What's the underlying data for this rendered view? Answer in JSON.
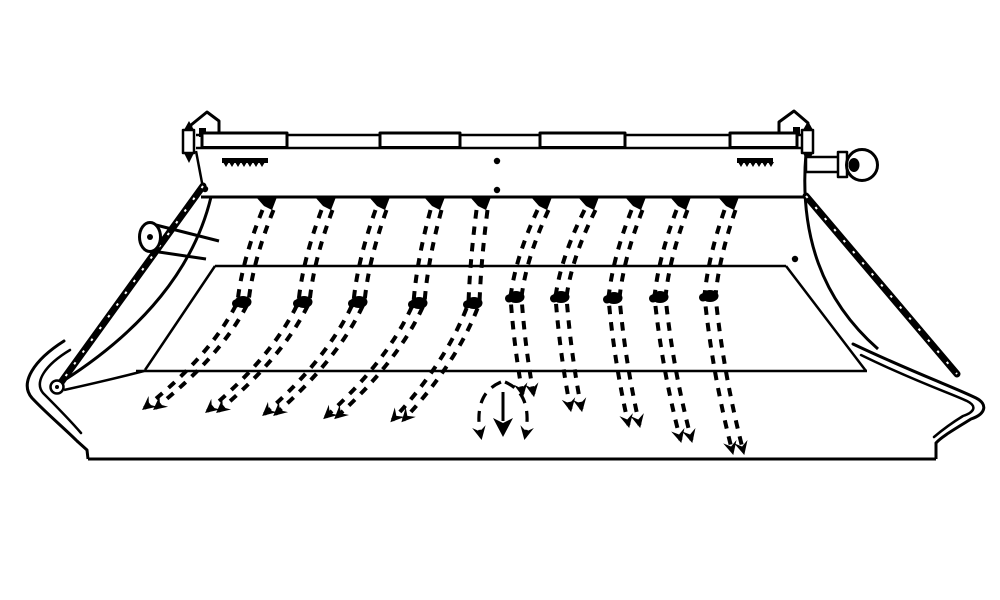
{
  "meta": {
    "background": "#ffffff",
    "ink": "#000000",
    "description": "black-and-white technical line drawing of an agricultural pickup header with ten double spring tines, segmented crossbar, side sheets, skid ends, crank knob and downward crop-flow arrow"
  },
  "crossbar": {
    "x1": 196,
    "x2": 806,
    "y_top": 135,
    "y_bottom": 148,
    "thick_segments": [
      [
        202,
        85
      ],
      [
        380,
        80
      ],
      [
        540,
        85
      ],
      [
        730,
        67
      ]
    ]
  },
  "toothed_racks": [
    {
      "x": 222,
      "w": 46,
      "y": 158
    },
    {
      "x": 737,
      "w": 36,
      "y": 158
    }
  ],
  "rivets": [
    {
      "x": 497,
      "y": 161
    },
    {
      "x": 497,
      "y": 190
    },
    {
      "x": 205,
      "y": 189
    },
    {
      "x": 795,
      "y": 259
    }
  ],
  "tines": [
    {
      "side": "left",
      "top": 268,
      "dot": 243,
      "dot_y": 302,
      "tip": 150,
      "tip_y": 408
    },
    {
      "side": "left",
      "top": 327,
      "dot": 304,
      "dot_y": 302,
      "tip": 213,
      "tip_y": 411
    },
    {
      "side": "left",
      "top": 381,
      "dot": 359,
      "dot_y": 302,
      "tip": 270,
      "tip_y": 414
    },
    {
      "side": "left",
      "top": 436,
      "dot": 419,
      "dot_y": 303,
      "tip": 331,
      "tip_y": 417
    },
    {
      "side": "left",
      "top": 482,
      "dot": 474,
      "dot_y": 303,
      "tip": 398,
      "tip_y": 420
    },
    {
      "side": "right",
      "top": 543,
      "dot": 516,
      "dot_y": 297,
      "tip": 528,
      "tip_y": 394
    },
    {
      "side": "right",
      "top": 590,
      "dot": 561,
      "dot_y": 297,
      "tip": 576,
      "tip_y": 409
    },
    {
      "side": "right",
      "top": 637,
      "dot": 614,
      "dot_y": 298,
      "tip": 634,
      "tip_y": 425
    },
    {
      "side": "right",
      "top": 682,
      "dot": 660,
      "dot_y": 297,
      "tip": 686,
      "tip_y": 440
    },
    {
      "side": "right",
      "top": 730,
      "dot": 710,
      "dot_y": 296,
      "tip": 738,
      "tip_y": 452
    }
  ],
  "flow_arrow": {
    "cx": 503,
    "top_y": 382,
    "bottom_y": 437
  }
}
